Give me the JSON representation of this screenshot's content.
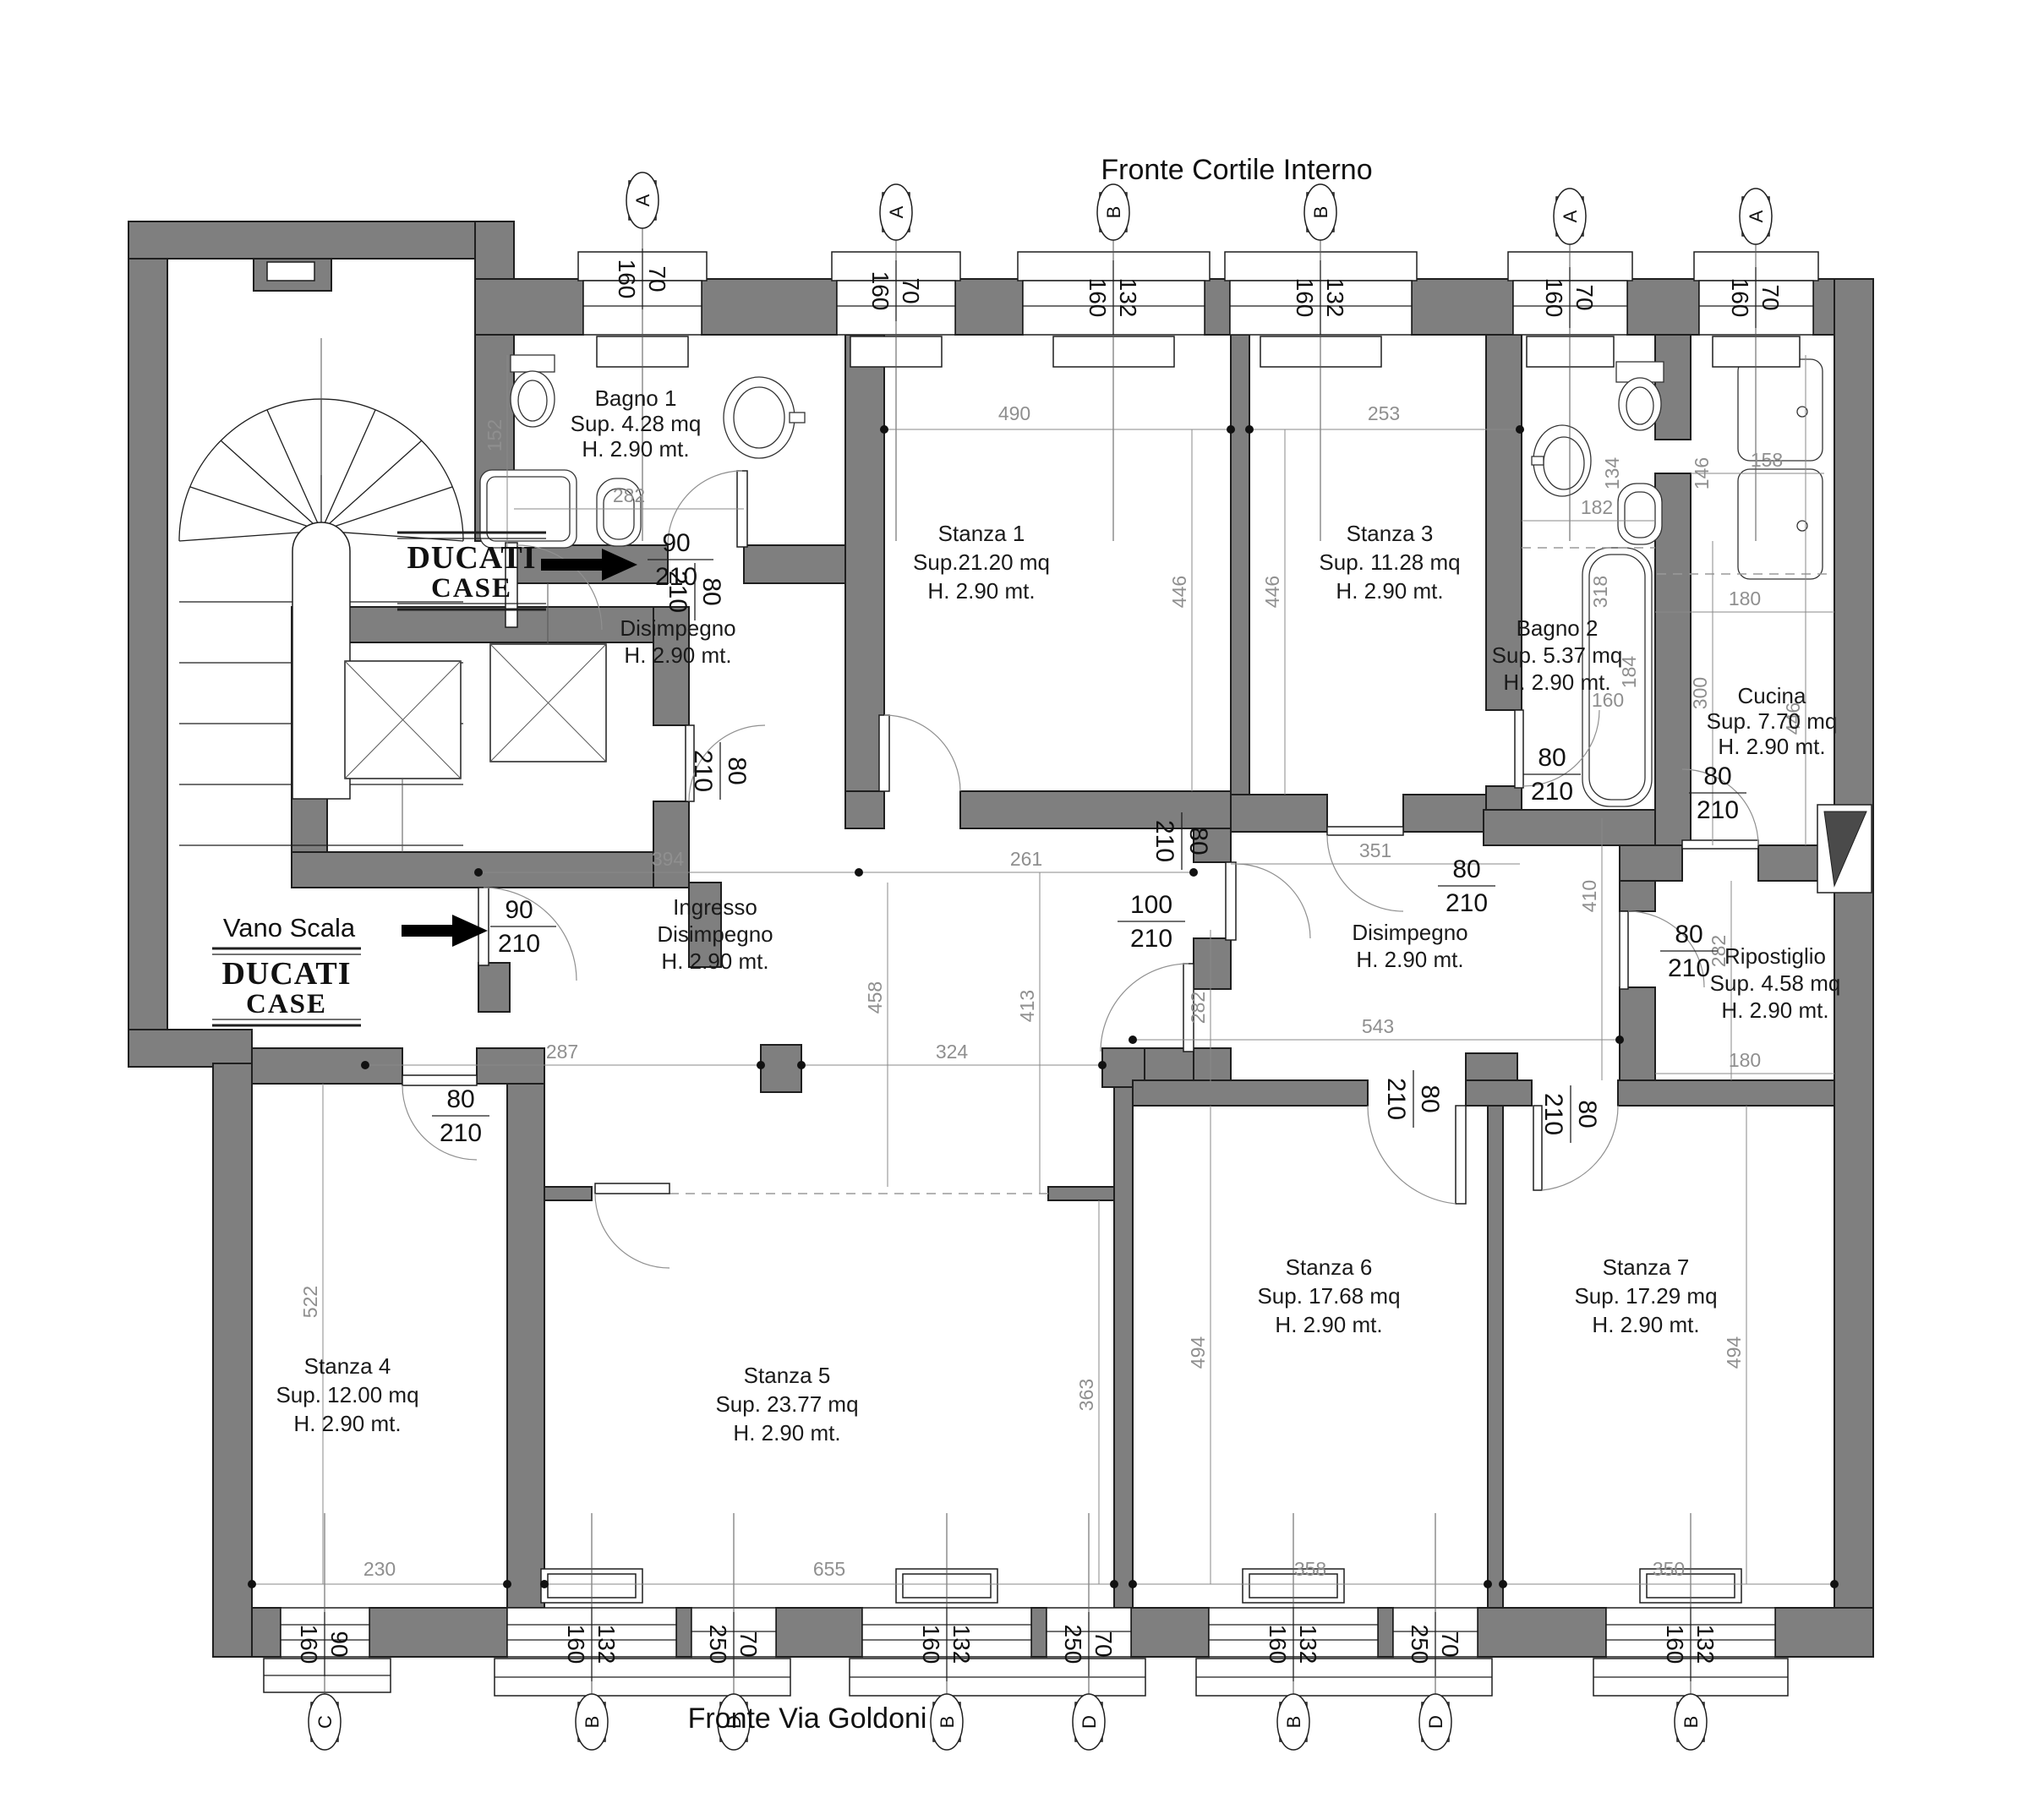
{
  "colors": {
    "wall_fill": "#7f7f7f",
    "wall_outline": "#1f1f1f",
    "dim_text": "#8f8f8f",
    "text": "#1a1a1a",
    "background": "#ffffff"
  },
  "titles": {
    "top": "Fronte Cortile Interno",
    "bottom": "Fronte Via Goldoni"
  },
  "stairwell": {
    "label": "Vano Scala"
  },
  "logo": {
    "line1": "DUCATI",
    "line2": "CASE"
  },
  "rooms": {
    "bagno1": {
      "name": "Bagno 1",
      "sup": "Sup. 4.28 mq",
      "h": "H. 2.90 mt."
    },
    "stanza1": {
      "name": "Stanza 1",
      "sup": "Sup.21.20 mq",
      "h": "H. 2.90 mt."
    },
    "stanza3": {
      "name": "Stanza 3",
      "sup": "Sup. 11.28 mq",
      "h": "H. 2.90 mt."
    },
    "bagno2": {
      "name": "Bagno 2",
      "sup": "Sup. 5.37 mq",
      "h": "H. 2.90 mt."
    },
    "cucina": {
      "name": "Cucina",
      "sup": "Sup. 7.70 mq",
      "h": "H. 2.90 mt."
    },
    "disimpegno_nord": {
      "name": "Disimpegno",
      "h": "H. 2.90 mt."
    },
    "ingresso": {
      "name": "Ingresso",
      "name2": "Disimpegno",
      "h": "H. 2.90 mt."
    },
    "disimpegno_est": {
      "name": "Disimpegno",
      "h": "H. 2.90 mt."
    },
    "ripostiglio": {
      "name": "Ripostiglio",
      "sup": "Sup. 4.58 mq",
      "h": "H. 2.90 mt."
    },
    "stanza4": {
      "name": "Stanza 4",
      "sup": "Sup. 12.00 mq",
      "h": "H. 2.90 mt."
    },
    "stanza5": {
      "name": "Stanza 5",
      "sup": "Sup. 23.77 mq",
      "h": "H. 2.90 mt."
    },
    "stanza6": {
      "name": "Stanza 6",
      "sup": "Sup. 17.68 mq",
      "h": "H. 2.90 mt."
    },
    "stanza7": {
      "name": "Stanza 7",
      "sup": "Sup. 17.29 mq",
      "h": "H. 2.90 mt."
    }
  },
  "doors": {
    "entrata_nord": {
      "w": "90",
      "h": "210"
    },
    "entrata_scala": {
      "w": "90",
      "h": "210"
    },
    "centro_100": {
      "w": "100",
      "h": "210"
    },
    "bagno1": {
      "w": "80",
      "h": "210"
    },
    "disimpegno": {
      "w": "80",
      "h": "210"
    },
    "stanza1": {
      "w": "80",
      "h": "210"
    },
    "stanza4": {
      "w": "80",
      "h": "210"
    },
    "stanza3": {
      "w": "80",
      "h": "210"
    },
    "bagno2": {
      "w": "80",
      "h": "210"
    },
    "cucina": {
      "w": "80",
      "h": "210"
    },
    "ripostiglio": {
      "w": "80",
      "h": "210"
    },
    "stanza6": {
      "w": "80",
      "h": "210"
    },
    "stanza7": {
      "w": "80",
      "h": "210"
    }
  },
  "windows_top": [
    {
      "letter": "A",
      "w": "70",
      "h": "160"
    },
    {
      "letter": "A",
      "w": "70",
      "h": "160"
    },
    {
      "letter": "B",
      "w": "132",
      "h": "160"
    },
    {
      "letter": "B",
      "w": "132",
      "h": "160"
    },
    {
      "letter": "A",
      "w": "70",
      "h": "160"
    },
    {
      "letter": "A",
      "w": "70",
      "h": "160"
    }
  ],
  "windows_bottom": [
    {
      "letter": "C",
      "w": "90",
      "h": "160"
    },
    {
      "letter": "B",
      "w": "132",
      "h": "160"
    },
    {
      "letter": "D",
      "w": "70",
      "h": "250"
    },
    {
      "letter": "B",
      "w": "132",
      "h": "160"
    },
    {
      "letter": "D",
      "w": "70",
      "h": "250"
    },
    {
      "letter": "B",
      "w": "132",
      "h": "160"
    },
    {
      "letter": "D",
      "w": "70",
      "h": "250"
    },
    {
      "letter": "B",
      "w": "132",
      "h": "160"
    }
  ],
  "dims": {
    "d490": "490",
    "d253": "253",
    "d152": "152",
    "d282_bagno1": "282",
    "d134": "134",
    "d182": "182",
    "d146": "146",
    "d158": "158",
    "d318": "318",
    "d184": "184",
    "d160": "160",
    "d180_cucina": "180",
    "d446_st1": "446",
    "d446_st3": "446",
    "d446_cucina": "446",
    "d300": "300",
    "d394": "394",
    "d261": "261",
    "d351": "351",
    "d410": "410",
    "d458": "458",
    "d413": "413",
    "d282_centro": "282",
    "d543": "543",
    "d282_rip": "282",
    "d180_rip": "180",
    "d287": "287",
    "d324": "324",
    "d230": "230",
    "d655": "655",
    "d522": "522",
    "d363": "363",
    "d494_st6": "494",
    "d494_st7": "494",
    "d358": "358",
    "d350": "350"
  }
}
